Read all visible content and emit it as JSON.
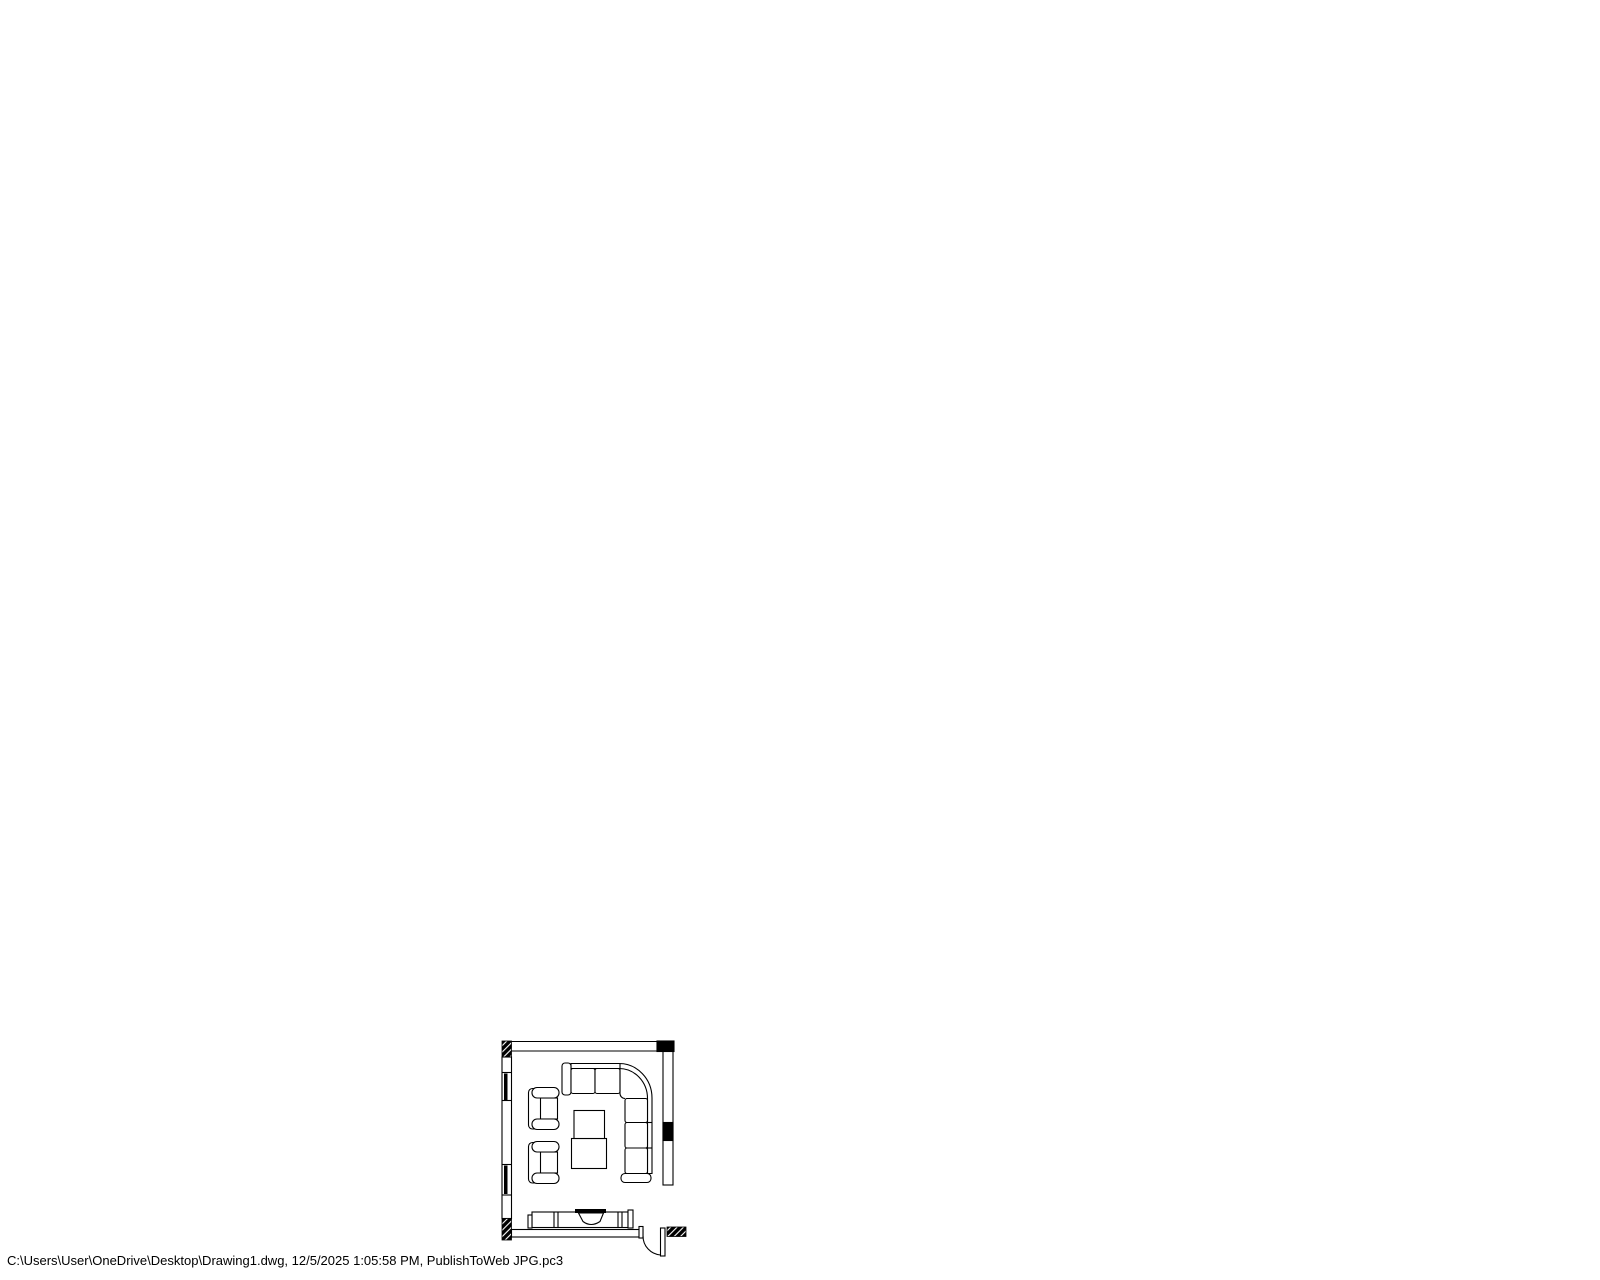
{
  "page": {
    "background_color": "#ffffff",
    "line_color": "#000000"
  },
  "footer": {
    "plot_stamp": "C:\\Users\\User\\OneDrive\\Desktop\\Drawing1.dwg, 12/5/2025 1:05:58 PM, PublishToWeb JPG.pc3"
  },
  "drawing": {
    "type": "floor-plan",
    "description": "Single-room CAD floor plan plotted to white sheet",
    "elements": [
      "top-wall",
      "left-wall",
      "right-wall",
      "bottom-wall",
      "hatched-corner-column-top-left",
      "hatched-corner-column-bottom-left",
      "solid-block-top-right",
      "solid-block-right-wall",
      "window-upper-left-wall",
      "window-lower-left-wall",
      "door-bottom-right",
      "door-swing-arc",
      "hatched-door-jamb",
      "sectional-sofa",
      "armchair-upper",
      "armchair-lower",
      "coffee-table",
      "tv-console",
      "tv"
    ]
  }
}
